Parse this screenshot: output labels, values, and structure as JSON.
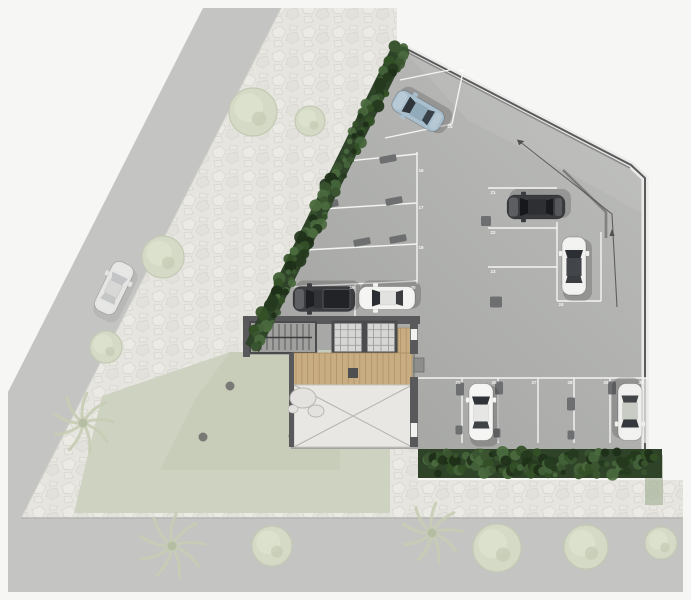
{
  "plan": {
    "type": "architectural-site-plan",
    "stall_numbers": [
      {
        "n": "14",
        "x": 462,
        "y": 72
      },
      {
        "n": "15",
        "x": 450,
        "y": 128
      },
      {
        "n": "16",
        "x": 421,
        "y": 172
      },
      {
        "n": "17",
        "x": 421,
        "y": 209
      },
      {
        "n": "18",
        "x": 421,
        "y": 249
      },
      {
        "n": "19",
        "x": 352,
        "y": 289
      },
      {
        "n": "20",
        "x": 413,
        "y": 289
      },
      {
        "n": "21",
        "x": 493,
        "y": 194
      },
      {
        "n": "22",
        "x": 493,
        "y": 234
      },
      {
        "n": "23",
        "x": 493,
        "y": 273
      },
      {
        "n": "24",
        "x": 561,
        "y": 306
      },
      {
        "n": "25",
        "x": 458,
        "y": 384
      },
      {
        "n": "26",
        "x": 494,
        "y": 384
      },
      {
        "n": "27",
        "x": 534,
        "y": 384
      },
      {
        "n": "28",
        "x": 570,
        "y": 384
      },
      {
        "n": "29",
        "x": 606,
        "y": 384
      },
      {
        "n": "30",
        "x": 641,
        "y": 384
      }
    ],
    "stall_lines": [
      {
        "x1": 400,
        "y1": 80,
        "x2": 464,
        "y2": 67
      },
      {
        "x1": 385,
        "y1": 138,
        "x2": 452,
        "y2": 124
      },
      {
        "x1": 464,
        "y1": 67,
        "x2": 452,
        "y2": 124
      },
      {
        "x1": 338,
        "y1": 162,
        "x2": 417,
        "y2": 154
      },
      {
        "x1": 322,
        "y1": 209,
        "x2": 417,
        "y2": 203
      },
      {
        "x1": 305,
        "y1": 250,
        "x2": 417,
        "y2": 244
      },
      {
        "x1": 288,
        "y1": 287,
        "x2": 417,
        "y2": 281
      },
      {
        "x1": 417,
        "y1": 152,
        "x2": 417,
        "y2": 284
      },
      {
        "x1": 355,
        "y1": 284,
        "x2": 355,
        "y2": 316
      },
      {
        "x1": 488,
        "y1": 188,
        "x2": 557,
        "y2": 188
      },
      {
        "x1": 488,
        "y1": 228,
        "x2": 557,
        "y2": 228
      },
      {
        "x1": 488,
        "y1": 267,
        "x2": 557,
        "y2": 267
      },
      {
        "x1": 557,
        "y1": 222,
        "x2": 557,
        "y2": 301
      },
      {
        "x1": 557,
        "y1": 301,
        "x2": 601,
        "y2": 301
      },
      {
        "x1": 601,
        "y1": 232,
        "x2": 601,
        "y2": 301
      },
      {
        "x1": 417,
        "y1": 378,
        "x2": 648,
        "y2": 378
      },
      {
        "x1": 462,
        "y1": 378,
        "x2": 462,
        "y2": 443
      },
      {
        "x1": 498,
        "y1": 378,
        "x2": 498,
        "y2": 443
      },
      {
        "x1": 538,
        "y1": 378,
        "x2": 538,
        "y2": 443
      },
      {
        "x1": 574,
        "y1": 378,
        "x2": 574,
        "y2": 443
      },
      {
        "x1": 610,
        "y1": 378,
        "x2": 610,
        "y2": 443
      },
      {
        "x1": 645,
        "y1": 378,
        "x2": 645,
        "y2": 443
      }
    ],
    "wheel_stops": [
      {
        "x": 388,
        "y": 159,
        "w": 17,
        "h": 7,
        "r": -11
      },
      {
        "x": 330,
        "y": 204,
        "w": 17,
        "h": 7,
        "r": -11
      },
      {
        "x": 394,
        "y": 201,
        "w": 17,
        "h": 7,
        "r": -11
      },
      {
        "x": 362,
        "y": 242,
        "w": 17,
        "h": 7,
        "r": -11
      },
      {
        "x": 398,
        "y": 239,
        "w": 17,
        "h": 7,
        "r": -11
      },
      {
        "x": 486,
        "y": 221,
        "w": 10,
        "h": 10,
        "r": 0
      },
      {
        "x": 496,
        "y": 302,
        "w": 12,
        "h": 11,
        "r": 0
      },
      {
        "x": 460,
        "y": 389,
        "w": 8,
        "h": 13,
        "r": 0
      },
      {
        "x": 499,
        "y": 388,
        "w": 8,
        "h": 13,
        "r": 0
      },
      {
        "x": 571,
        "y": 404,
        "w": 8,
        "h": 13,
        "r": 0
      },
      {
        "x": 612,
        "y": 388,
        "w": 8,
        "h": 13,
        "r": 0
      },
      {
        "x": 459,
        "y": 430,
        "w": 7,
        "h": 9,
        "r": 0
      },
      {
        "x": 497,
        "y": 433,
        "w": 7,
        "h": 9,
        "r": 0
      },
      {
        "x": 571,
        "y": 435,
        "w": 7,
        "h": 9,
        "r": 0
      }
    ],
    "cars": [
      {
        "type": "sedan",
        "x": 418,
        "y": 111,
        "rot": -60,
        "len": 54,
        "wid": 23,
        "body": "#a9bfcd",
        "roof": "#92abbb",
        "glass": "#2e363c"
      },
      {
        "type": "sedan",
        "x": 536,
        "y": 207,
        "rot": -90,
        "len": 58,
        "wid": 24,
        "body": "#3a3b3f",
        "roof": "#2e2f33",
        "glass": "#17181b"
      },
      {
        "type": "sedan",
        "x": 574,
        "y": 266,
        "rot": 0,
        "len": 58,
        "wid": 24,
        "body": "#f1f1ef",
        "roof": "#42464b",
        "glass": "#2b2e32"
      },
      {
        "type": "pickup",
        "x": 324,
        "y": 299,
        "rot": -90,
        "len": 62,
        "wid": 25,
        "body": "#3c3d41",
        "roof": "#323337",
        "glass": "#1e1f23"
      },
      {
        "type": "sedan",
        "x": 387,
        "y": 298,
        "rot": -90,
        "len": 56,
        "wid": 23,
        "body": "#f3f3f1",
        "roof": "#e2e2e0",
        "glass": "#2b2e32"
      },
      {
        "type": "sedan",
        "x": 481,
        "y": 412,
        "rot": 0,
        "len": 57,
        "wid": 24,
        "body": "#f4f4f2",
        "roof": "#e6e6e4",
        "glass": "#2f3236"
      },
      {
        "type": "sedan",
        "x": 630,
        "y": 412,
        "rot": 180,
        "len": 57,
        "wid": 24,
        "body": "#eff0ee",
        "roof": "#c9ccc4",
        "glass": "#34373b"
      },
      {
        "type": "sedan",
        "x": 114,
        "y": 288,
        "rot": 26,
        "len": 54,
        "wid": 23,
        "body": "#ebebe9",
        "roof": "#dcdcda",
        "glass": "#c2c4c6",
        "faded": true
      }
    ],
    "trees": [
      {
        "x": 253,
        "y": 112,
        "r": 24
      },
      {
        "x": 310,
        "y": 121,
        "r": 15
      },
      {
        "x": 163,
        "y": 257,
        "r": 21
      },
      {
        "x": 106,
        "y": 347,
        "r": 16
      },
      {
        "x": 497,
        "y": 548,
        "r": 24
      },
      {
        "x": 586,
        "y": 547,
        "r": 22
      },
      {
        "x": 661,
        "y": 543,
        "r": 16
      },
      {
        "x": 272,
        "y": 546,
        "r": 20
      }
    ],
    "palms": [
      {
        "x": 83,
        "y": 423,
        "r": 30
      },
      {
        "x": 172,
        "y": 546,
        "r": 33
      },
      {
        "x": 432,
        "y": 533,
        "r": 30
      }
    ],
    "bollards": [
      {
        "x": 230,
        "y": 386
      },
      {
        "x": 203,
        "y": 437
      },
      {
        "x": 293,
        "y": 436
      },
      {
        "x": 350,
        "y": 432
      },
      {
        "x": 412,
        "y": 432
      }
    ],
    "arrow": {
      "path": "M617,307 L612,214 L519,141",
      "head1": "517,139.5 524.3,141.1 519.1,145.2",
      "head2": "612,229 614.6,236 609.4,236"
    },
    "palette": {
      "bg": "#f6f6f4",
      "road": "#c4c4c2",
      "sidewalk": "#e6e5e0",
      "stone_line": "#d6d5cf",
      "lawn": "#cdd2c1",
      "lawn_dark": "#c2c8b2",
      "lot_light": "#bcbdbb",
      "lot_dark": "#a2a3a1",
      "wall_light": "#ebebe9",
      "wall_dark": "#5a5a5c",
      "hedge_base": "#2e4328",
      "hedge_greens": [
        "#3a5530",
        "#253a1e",
        "#44633a",
        "#1f3019",
        "#335026",
        "#4a6a3e"
      ],
      "stall_line": "#f4f4f2",
      "stop_fill": "#6e6f71",
      "pillar": "#515254",
      "number": "#ffffff",
      "arrow": "#4f4f4d",
      "wood": "#c9ad82",
      "wood_line": "#b09068",
      "pave": "#e8e7e3",
      "pave_line": "#b4b3af",
      "stair_fill": "#a0a09e",
      "core_wall": "#59595b",
      "elev_fill": "#d6d6d4",
      "tree_fill": "#d5dac7",
      "tree_edge": "#c3cab4",
      "tree_core": "#dde2cf",
      "palm": "#c6cdb4",
      "bollard": "#6b6b68",
      "curb": "#b0b0ae"
    }
  }
}
